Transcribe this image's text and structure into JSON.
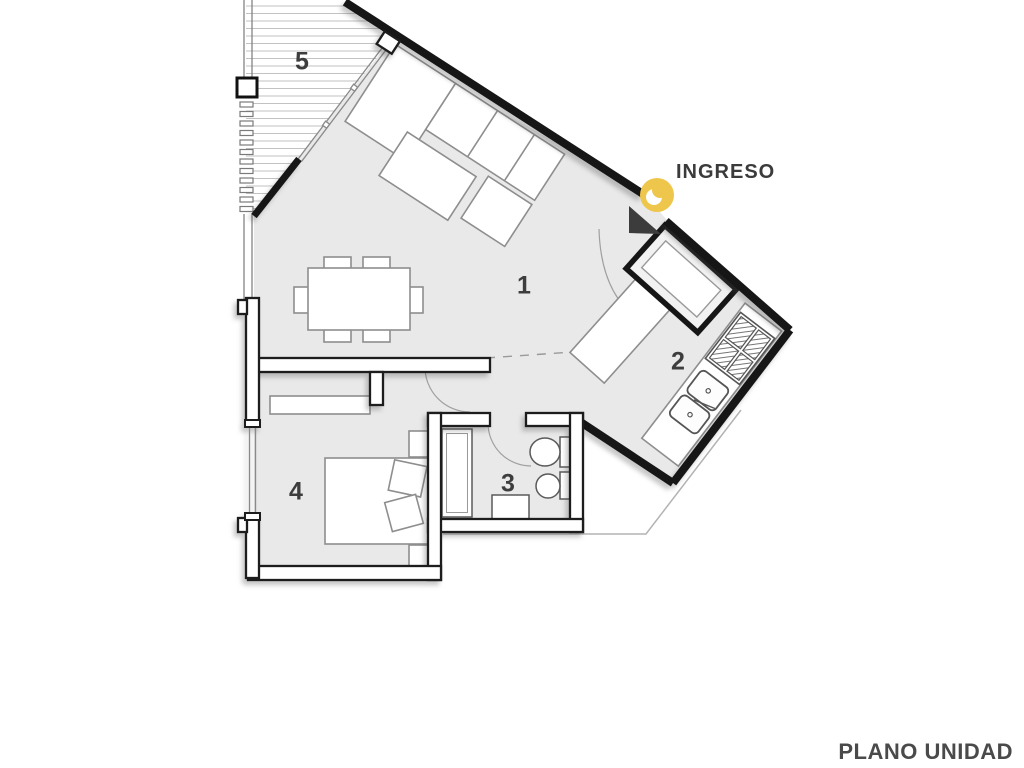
{
  "title": "PLANO UNIDAD",
  "entrance": {
    "label": "INGRESO",
    "icon": "entry-direction-icon"
  },
  "rooms": [
    {
      "number": "1",
      "name": "living-dining"
    },
    {
      "number": "2",
      "name": "kitchen"
    },
    {
      "number": "3",
      "name": "bathroom"
    },
    {
      "number": "4",
      "name": "bedroom"
    },
    {
      "number": "5",
      "name": "balcony"
    }
  ],
  "colors": {
    "accent_yellow": "#EFC64C",
    "wall": "#1a1a1a",
    "floor": "#e9e9e9",
    "furniture_outline": "#8e8e8e",
    "label_text": "#3d3d3d"
  }
}
